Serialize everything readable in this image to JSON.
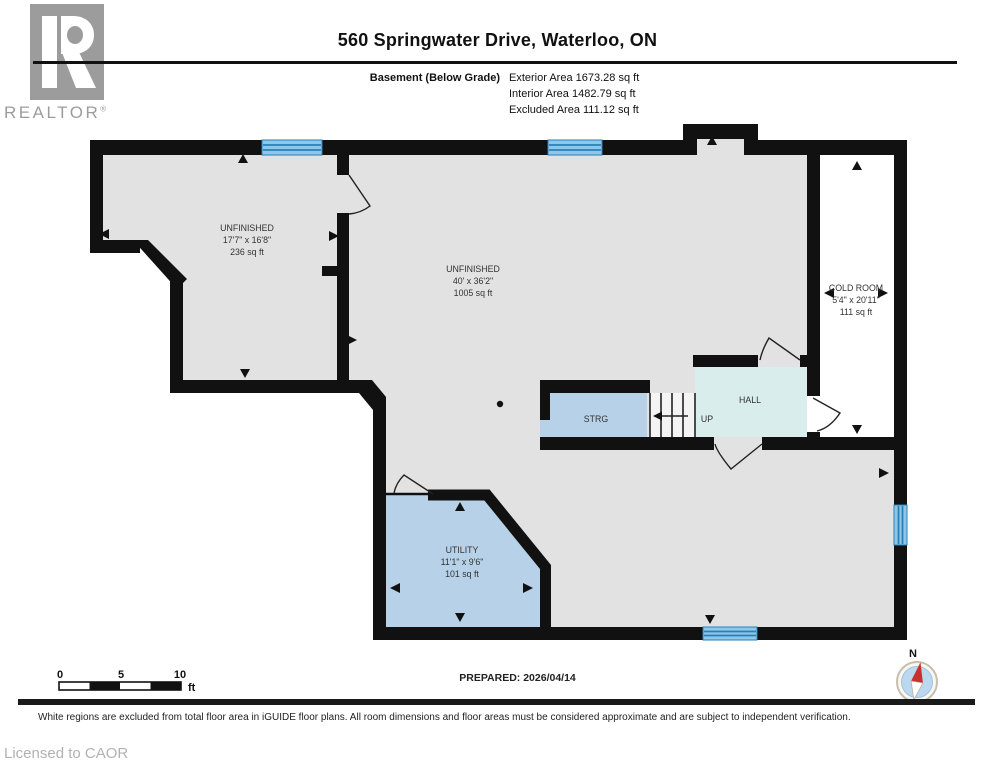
{
  "header": {
    "title": "560 Springwater Drive, Waterloo, ON",
    "floor_label": "Basement (Below Grade)",
    "exterior_area": "Exterior Area 1673.28 sq ft",
    "interior_area": "Interior Area 1482.79 sq ft",
    "excluded_area": "Excluded Area 111.12 sq ft"
  },
  "logo": {
    "letter": "R",
    "brand": "REALTOR",
    "registered": "®"
  },
  "rooms": {
    "unfinished_left": {
      "name": "UNFINISHED",
      "dims": "17'7\" x 16'8\"",
      "area": "236 sq ft"
    },
    "unfinished_main": {
      "name": "UNFINISHED",
      "dims": "40' x 36'2\"",
      "area": "1005 sq ft"
    },
    "cold_room": {
      "name": "COLD ROOM",
      "dims": "5'4\" x 20'11\"",
      "area": "111 sq ft"
    },
    "utility": {
      "name": "UTILITY",
      "dims": "11'1\" x 9'6\"",
      "area": "101 sq ft"
    },
    "hall": {
      "name": "HALL"
    },
    "storage": {
      "name": "STRG"
    },
    "stairs": {
      "label": "UP"
    }
  },
  "scale_bar": {
    "start": "0",
    "mid": "5",
    "end": "10",
    "unit": "ft"
  },
  "compass": {
    "label": "N"
  },
  "footer": {
    "prepared": "PREPARED: 2026/04/14",
    "disclaimer": "White regions are excluded from total floor area in iGUIDE floor plans. All room dimensions and floor areas must be considered approximate and are subject to independent verification.",
    "license": "Licensed to CAOR"
  },
  "colors": {
    "wall": "#111111",
    "floor_gray": "#e2e2e2",
    "room_blue": "#b7d2e8",
    "hall_teal": "#d9edec",
    "window_fill": "#8ec7e8",
    "window_stripe": "#2a7fb8",
    "compass_red": "#c9302c",
    "compass_blue": "#bcd8ee",
    "logo_gray": "#9c9c9c",
    "license_gray": "#b2b2b2"
  }
}
